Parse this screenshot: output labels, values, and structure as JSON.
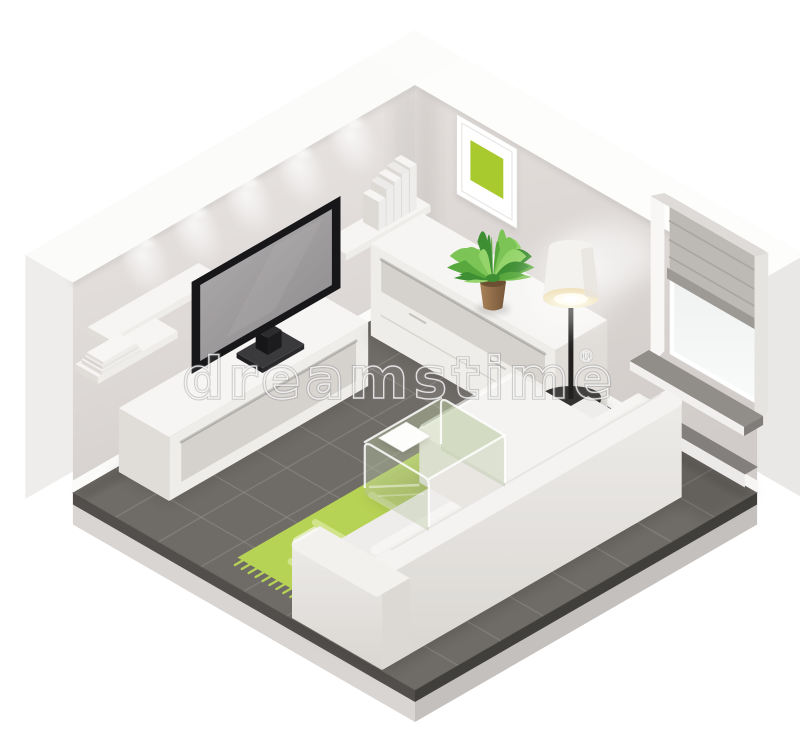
{
  "illustration": {
    "subject": "isometric living room cutaway icon",
    "style": "flat vector isometric"
  },
  "watermark": {
    "text": "dreamstime",
    "symbol": "®"
  },
  "palette": {
    "background": "#ffffff",
    "wall_left_light": "#eae6e4",
    "wall_left_dark": "#d7d2d0",
    "wall_right_light": "#e2ddda",
    "wall_right_dark": "#d2cdca",
    "wall_top": "#fbfbfa",
    "wall_outer_left": "#efedec",
    "wall_outer_right": "#eae8e6",
    "baseboard": "#fbfbfa",
    "floor": "#6f6b67",
    "floor_grid": "#918e8a",
    "slab_left": "#514e4b",
    "slab_right": "#413f3c",
    "base_left": "#d8d5d2",
    "base_right": "#c3c0bd",
    "furniture_top": "#f6f5f3",
    "furniture_front": "#efede9",
    "furniture_side": "#e0ddd9",
    "recess": "#d5d2ce",
    "tv_bezel": "#17171a",
    "tv_screen_light": "#b3b0b2",
    "tv_screen_dark": "#8e8b8d",
    "rug": "#b7d355",
    "rug_stripe": "#d7e795",
    "art_green": "#a8ca2f",
    "plant_dark": "#3e8e33",
    "plant_mid": "#58a83e",
    "plant_light": "#7cc455",
    "plant_pale": "#95d46b",
    "pot": "#9a7550",
    "pot_dark": "#6b4f33",
    "lamp_black": "#21201f",
    "lamp_shade": "#f4f2ef",
    "lamp_glow": "#fff3d8",
    "blind": "#bdb9b5",
    "blind_rail": "#9d9995",
    "sill": "#918e8a",
    "sofa_top": "#f4f3f1",
    "sofa_front": "#e9e6e2",
    "sofa_back": "#dddad6",
    "glass_fill": "rgba(172,190,150,0.34)",
    "glass_top": "rgba(198,214,170,0.38)",
    "glass_edge": "rgba(255,255,255,0.85)",
    "paper": "#fdfdfc"
  },
  "scene": {
    "items": [
      {
        "name": "tiled-floor"
      },
      {
        "name": "left-wall"
      },
      {
        "name": "right-wall"
      },
      {
        "name": "ceiling-spotlights"
      },
      {
        "name": "wall-shelf-with-books"
      },
      {
        "name": "wall-shelf-empty"
      },
      {
        "name": "wall-shelf-with-magazines"
      },
      {
        "name": "flat-screen-tv"
      },
      {
        "name": "tv-stand"
      },
      {
        "name": "picture-frame-green-art"
      },
      {
        "name": "sideboard"
      },
      {
        "name": "potted-plant"
      },
      {
        "name": "floor-lamp"
      },
      {
        "name": "window-with-roman-blind"
      },
      {
        "name": "green-rug"
      },
      {
        "name": "glass-coffee-table"
      },
      {
        "name": "magazine-on-table"
      },
      {
        "name": "white-corner-sofa"
      }
    ]
  }
}
